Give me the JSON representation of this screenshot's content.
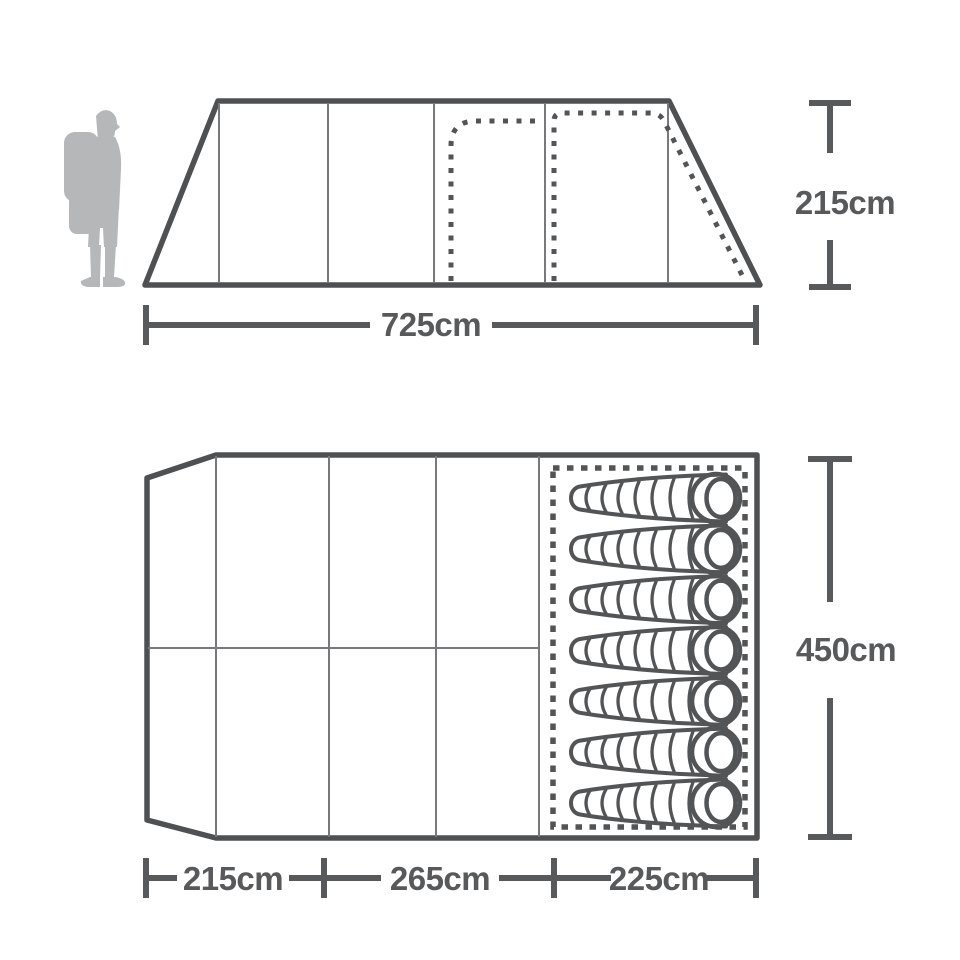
{
  "title": "Tent dimensions diagram",
  "colors": {
    "outline": "#4e5052",
    "thin_line": "#77797c",
    "dashed": "#525456",
    "dimension": "#58595b",
    "silhouette": "#b5b7b9",
    "background": "#ffffff"
  },
  "side_view": {
    "description": "Tent side elevation with hiker silhouette for scale, dashed inner bedroom outlines",
    "height_dimension": {
      "label": "215cm"
    },
    "width_dimension": {
      "label": "725cm"
    }
  },
  "floor_plan": {
    "description": "Tent floor plan with porch sections and bedroom containing sleeping bags",
    "depth_dimension": {
      "label": "450cm"
    },
    "width_dimensions": [
      {
        "label": "215cm"
      },
      {
        "label": "265cm"
      },
      {
        "label": "225cm"
      }
    ],
    "sleeping_bags": {
      "count": 7
    }
  }
}
